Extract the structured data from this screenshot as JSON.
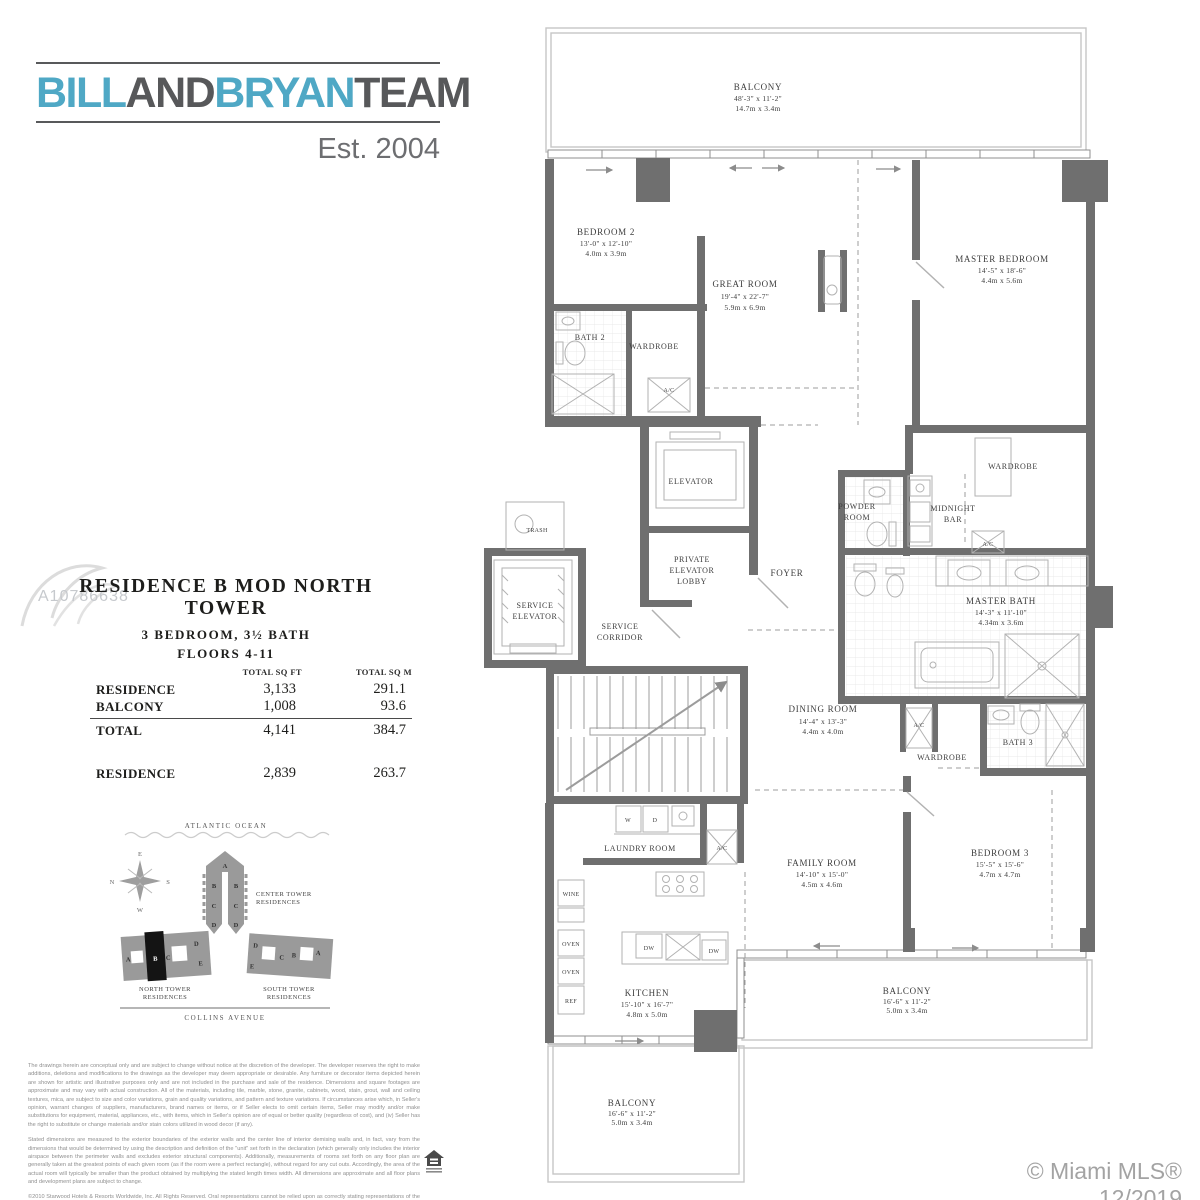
{
  "logo": {
    "bill": "BILL",
    "and": "AND",
    "bryan": "BRYAN",
    "team": "TEAM",
    "est": "Est. 2004",
    "blue": "#4FA8C5",
    "gray": "#57585A"
  },
  "watermark": {
    "listing_id": "A10786638",
    "credit": "© Miami MLS® 12/2019"
  },
  "residence_info": {
    "title": "RESIDENCE B MOD NORTH TOWER",
    "subtitle": "3 BEDROOM, 3½ BATH",
    "floors": "FLOORS 4-11",
    "table": {
      "headers": {
        "sqft": "TOTAL SQ FT",
        "sqm": "TOTAL SQ M"
      },
      "rows": [
        {
          "label": "RESIDENCE",
          "sqft": "3,133",
          "sqm": "291.1"
        },
        {
          "label": "BALCONY",
          "sqft": "1,008",
          "sqm": "93.6"
        },
        {
          "label": "TOTAL",
          "sqft": "4,141",
          "sqm": "384.7"
        }
      ],
      "modified_row": {
        "label": "RESIDENCE",
        "sqft": "2,839",
        "sqm": "263.7"
      }
    }
  },
  "sitemap": {
    "ocean_label": "ATLANTIC OCEAN",
    "street_label": "COLLINS AVENUE",
    "compass": {
      "top": "E",
      "right": "S",
      "bottom": "W",
      "left": "N"
    },
    "center_tower": {
      "line1": "CENTER TOWER",
      "line2": "RESIDENCES",
      "letters": [
        "A",
        "B",
        "B",
        "C",
        "C",
        "D",
        "D"
      ]
    },
    "north_tower": {
      "line1": "NORTH TOWER",
      "line2": "RESIDENCES",
      "letters": [
        "A",
        "B",
        "C",
        "D",
        "E"
      ]
    },
    "south_tower": {
      "line1": "SOUTH TOWER",
      "line2": "RESIDENCES",
      "letters": [
        "D",
        "C",
        "B",
        "A",
        "E"
      ]
    }
  },
  "floorplan": {
    "rooms": {
      "balcony_top": {
        "name": "BALCONY",
        "ft": "48'-3\" x 11'-2\"",
        "m": "14.7m x 3.4m"
      },
      "bedroom2": {
        "name": "BEDROOM 2",
        "ft": "13'-0\" x 12'-10\"",
        "m": "4.0m x 3.9m"
      },
      "great_room": {
        "name": "GREAT ROOM",
        "ft": "19'-4\" x 22'-7\"",
        "m": "5.9m x 6.9m"
      },
      "master_bedroom": {
        "name": "MASTER BEDROOM",
        "ft": "14'-5\" x 18'-6\"",
        "m": "4.4m x 5.6m"
      },
      "bath2": {
        "name": "BATH 2"
      },
      "wardrobe": {
        "name": "WARDROBE"
      },
      "elevator": {
        "name": "ELEVATOR"
      },
      "private_lobby": {
        "l1": "PRIVATE",
        "l2": "ELEVATOR",
        "l3": "LOBBY"
      },
      "service_elevator": {
        "l1": "SERVICE",
        "l2": "ELEVATOR"
      },
      "service_corridor": {
        "l1": "SERVICE",
        "l2": "CORRIDOR"
      },
      "foyer": {
        "name": "FOYER"
      },
      "powder_room": {
        "l1": "POWDER",
        "l2": "ROOM"
      },
      "midnight_bar": {
        "l1": "MIDNIGHT",
        "l2": "BAR"
      },
      "master_bath": {
        "name": "MASTER BATH",
        "ft": "14'-3\" x 11'-10\"",
        "m": "4.34m x 3.6m"
      },
      "dining_room": {
        "name": "DINING ROOM",
        "ft": "14'-4\" x 13'-3\"",
        "m": "4.4m x 4.0m"
      },
      "bath3": {
        "name": "BATH 3"
      },
      "laundry_room": {
        "name": "LAUNDRY ROOM"
      },
      "kitchen": {
        "name": "KITCHEN",
        "ft": "15'-10\" x 16'-7\"",
        "m": "4.8m x 5.0m"
      },
      "family_room": {
        "name": "FAMILY ROOM",
        "ft": "14'-10\" x 15'-0\"",
        "m": "4.5m x 4.6m"
      },
      "bedroom3": {
        "name": "BEDROOM 3",
        "ft": "15'-5\" x 15'-6\"",
        "m": "4.7m x 4.7m"
      },
      "balcony_right": {
        "name": "BALCONY",
        "ft": "16'-6\" x 11'-2\"",
        "m": "5.0m x 3.4m"
      },
      "balcony_bottom": {
        "name": "BALCONY",
        "ft": "16'-6\" x 11'-2\"",
        "m": "5.0m x 3.4m"
      }
    },
    "labels": {
      "ac": "A/C",
      "trash": "TRASH",
      "w": "W",
      "d": "D",
      "dw": "DW",
      "wine": "WINE",
      "oven": "OVEN",
      "ref": "REF"
    }
  },
  "legal": {
    "para1": "The drawings herein are conceptual only and are subject to change without notice at the discretion of the developer. The developer reserves the right to make additions, deletions and modifications to the drawings as the developer may deem appropriate or desirable. Any furniture or decorator items depicted herein are shown for artistic and illustrative purposes only and are not included in the purchase and sale of the residence. Dimensions and square footages are approximate and may vary with actual construction. All of the materials, including tile, marble, stone, granite, cabinets, wood, stain, grout, wall and ceiling textures, mica, are subject to size and color variations, grain and quality variations, and pattern and texture variations. If circumstances arise which, in Seller's opinion, warrant changes of suppliers, manufacturers, brand names or items, or if Seller elects to omit certain items, Seller may modify and/or make substitutions for equipment, material, appliances, etc., with items, which in Seller's opinion are of equal or better quality (regardless of cost), and (iv) Seller has the right to substitute or change materials and/or stain colors utilized in wood decor (if any).",
    "para2": "Stated dimensions are measured to the exterior boundaries of the exterior walls and the center line of interior demising walls and, in fact, vary from the dimensions that would be determined by using the description and definition of the \"unit\" set forth in the declaration (which generally only includes the interior airspace between the perimeter walls and excludes exterior structural components). Additionally, measurements of rooms set forth on any floor plan are generally taken at the greatest points of each given room (as if the room were a perfect rectangle), without regard for any cut outs. Accordingly, the area of the actual room will typically be smaller than the product obtained by multiplying the stated length times width. All dimensions are approximate and all floor plans and development plans are subject to change.",
    "para3": "©2010 Starwood Hotels & Resorts Worldwide, Inc. All Rights Reserved. Oral representations cannot be relied upon as correctly stating representations of the developer. For correct representations, make reference to the documents required by section 718.503, Florida statutes, to be furnished by a developer to a buyer or lessee. Certain units in this condominium are subject to timeshare estates. Obtain the property report required by federal law and read it before signing anything. No federal agency has judged the merits or value, if any, of this property. This offering is made only by the prospectus for the condominium and no statement should be relied upon if not made in the prospectus. Not an offering where prohibited by state law. The developer's use of the St. Regis™ trademarks is pursuant to a license from the Sheraton LLC. The complete offering terms are in a offering plan available from the sponsor file no. 07-0294."
  }
}
